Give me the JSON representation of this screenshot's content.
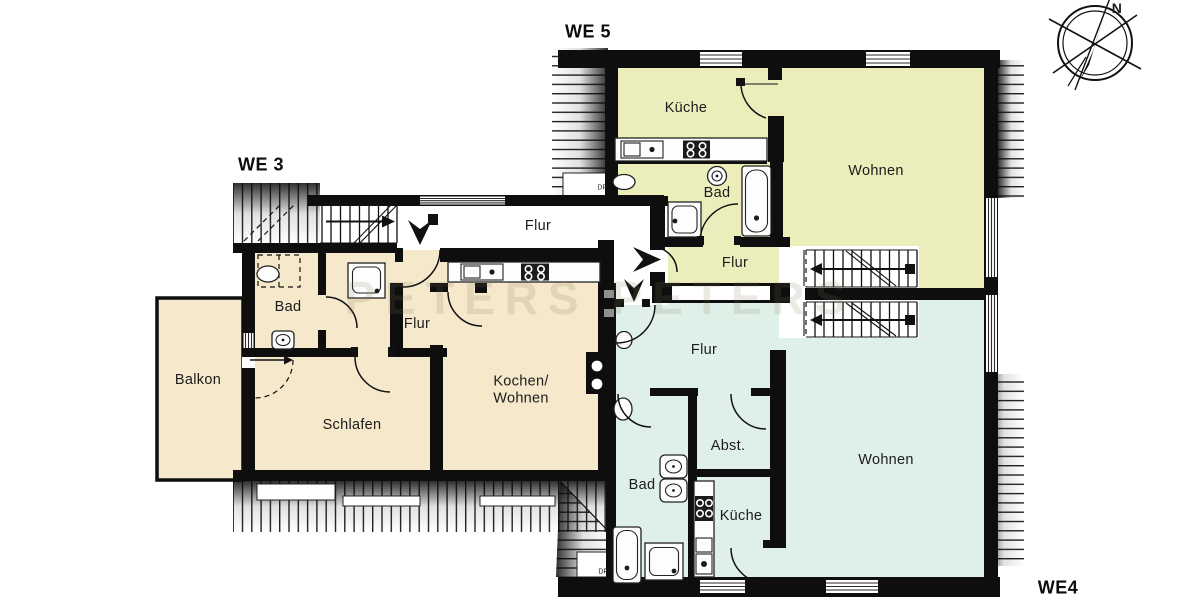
{
  "colors": {
    "beige": "#f5e8cb",
    "yellow": "#ebeebb",
    "mint": "#def0e7",
    "wall": "#0e0e0e"
  },
  "compass": {
    "north_label": "N"
  },
  "watermark": {
    "text": "PETERS PETERS"
  },
  "shared": {
    "corridor_flur": "Flur"
  },
  "units": {
    "we3": {
      "label": "WE 3",
      "rooms": {
        "bad": "Bad",
        "flur": "Flur",
        "balkon": "Balkon",
        "schlafen": "Schlafen",
        "kochen_wohnen_line1": "Kochen/",
        "kochen_wohnen_line2": "Wohnen"
      }
    },
    "we5": {
      "label": "WE 5",
      "rooms": {
        "kueche": "Küche",
        "bad": "Bad",
        "wohnen": "Wohnen",
        "flur": "Flur",
        "skylight": "DF"
      }
    },
    "we4": {
      "label": "WE4",
      "rooms": {
        "flur": "Flur",
        "abstellraum": "Abst.",
        "bad": "Bad",
        "kueche": "Küche",
        "wohnen": "Wohnen",
        "skylight": "DF"
      }
    }
  }
}
